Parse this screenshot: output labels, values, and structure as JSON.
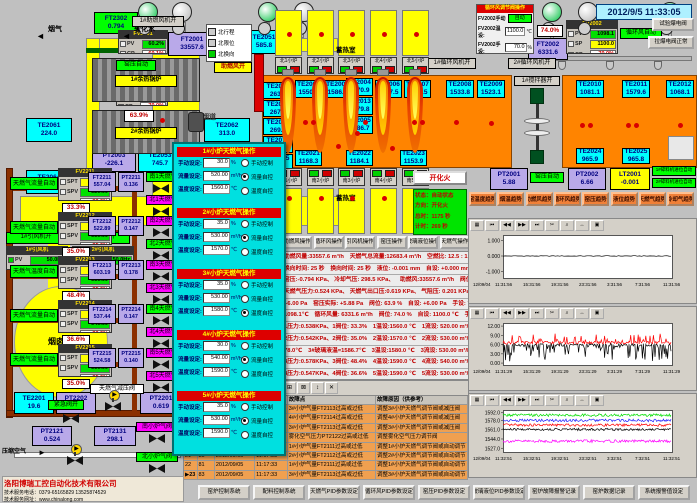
{
  "datetime": "2012/9/5 11:33:05",
  "top_left": {
    "smoke_label": "烟气",
    "soft_water_label": "软化水",
    "boiler1": "1#余热锅炉",
    "boiler2": "2#余热锅炉",
    "idfan1_on": "1#引风机开",
    "idfan2_on": "2#引风机开",
    "idfan1": "1#引风机",
    "idfan2": "2#引风机",
    "idfan_pv": "PV",
    "idfan1_hz": "50.0Hz",
    "idfan2_hz": "50.0Hz",
    "chimney": "烟囱",
    "flue": "烟道",
    "comb_fan_on": "1#助燃风机开",
    "comb_air_open": "助燃风开",
    "press_auto": "窑压自动",
    "reversal_items": [
      {
        "label": "北行程",
        "on": false
      },
      {
        "label": "北限位",
        "on": false
      },
      {
        "label": "北换向",
        "on": true
      }
    ]
  },
  "top_right": {
    "panel_title": "循环风调节阀操作",
    "manual_label": "FV2002手动",
    "manual_mode": "自动",
    "temp_label": "FV2002温设:",
    "temp_value": "1100.0",
    "temp_unit": "℃",
    "hand_label": "FV2002手设:",
    "hand_value": "70.0",
    "hand_unit": "%",
    "btn_test": "试验爆电阀",
    "btn_normal": "拉爆电阀正常",
    "circ_auto": "循环风自动",
    "circ_fan1_on": "1#循环风机开",
    "circ_fan2_on": "2#循环风机开",
    "stirrer1_on": "1#搅拌器开"
  },
  "furnace": {
    "regen_label_north": "蓄热室",
    "regen_label_south": "蓄热室",
    "fire_btn": "开化火",
    "status_lines": [
      "状态：自动状态",
      "方向：开化火",
      "总时：1175 秒",
      "计时：269 秒"
    ],
    "burners_north": [
      "北1小炉",
      "北2小炉",
      "北3小炉",
      "北4小炉",
      "北5小炉"
    ],
    "burners_south": [
      "南1小炉",
      "南2小炉",
      "南3小炉",
      "南4小炉",
      "南5小炉"
    ]
  },
  "sensors": [
    {
      "id": "FT2302",
      "v": "0.794"
    },
    {
      "id": "TE2061",
      "v": "224.0"
    },
    {
      "id": "TE2064",
      "v": "239.0"
    },
    {
      "id": "TE2062",
      "v": "313.0"
    },
    {
      "id": "TE2063",
      "v": "319.0"
    },
    {
      "id": "TE2051",
      "v": "585.8"
    },
    {
      "id": "TE2053",
      "v": "745.7"
    },
    {
      "id": "PT2003",
      "v": "-226.1"
    },
    {
      "id": "FT2001",
      "v": "33557.6"
    },
    {
      "id": "TE2031",
      "v": "1040.1"
    },
    {
      "id": "TE2032",
      "v": "1011.7"
    },
    {
      "id": "TE2033",
      "v": "1025.1"
    },
    {
      "id": "TE2034",
      "v": "1013.3"
    },
    {
      "id": "TE2035",
      "v": "1011.7"
    },
    {
      "id": "TE2071",
      "v": "263.0"
    },
    {
      "id": "TE2072",
      "v": "267.4"
    },
    {
      "id": "TE2073",
      "v": "269.6"
    },
    {
      "id": "TE2074",
      "v": "268.6"
    },
    {
      "id": "TE2075",
      "v": "268.8"
    },
    {
      "id": "TE2001",
      "v": "1550.8"
    },
    {
      "id": "TE2002",
      "v": "1586.2"
    },
    {
      "id": "TE2004",
      "v": "1570.9"
    },
    {
      "id": "TE2013",
      "v": "1579.8"
    },
    {
      "id": "TE2005",
      "v": "1586.7"
    },
    {
      "id": "TE2006",
      "v": "1567.5"
    },
    {
      "id": "TE2007",
      "v": "1538.5"
    },
    {
      "id": "TE2008",
      "v": "1533.8"
    },
    {
      "id": "TE2009",
      "v": "1523.1"
    },
    {
      "id": "TE2010",
      "v": "1081.1"
    },
    {
      "id": "TE2011",
      "v": "1579.6"
    },
    {
      "id": "TE2012",
      "v": "1068.1"
    },
    {
      "id": "TE2021",
      "v": "1168.3"
    },
    {
      "id": "TE2022",
      "v": "1184.1"
    },
    {
      "id": "TE2023",
      "v": "1153.9"
    },
    {
      "id": "TE2024",
      "v": "965.9"
    },
    {
      "id": "TE2025",
      "v": "965.8"
    },
    {
      "id": "TE2041",
      "v": "1209.6"
    },
    {
      "id": "TE2042",
      "v": "1215.0"
    },
    {
      "id": "TE2043",
      "v": "1224.8"
    },
    {
      "id": "TE2044",
      "v": "1212.6"
    },
    {
      "id": "TE2045",
      "v": "1211.8"
    },
    {
      "id": "FT2002",
      "v": "6331.6"
    },
    {
      "id": "PT2001",
      "v": "5.88"
    },
    {
      "id": "PT2002",
      "v": "6.66"
    },
    {
      "id": "LT2001",
      "v": "-0.001"
    },
    {
      "id": "TE2201",
      "v": "19.6"
    },
    {
      "id": "PT2202",
      "v": "0.265"
    },
    {
      "id": "PT2201",
      "v": "0.619"
    },
    {
      "id": "PT2121",
      "v": "0.524"
    },
    {
      "id": "PT2131",
      "v": "298.1"
    }
  ],
  "controllers": [
    {
      "id": "FV2001",
      "rows": [
        [
          "PV",
          "60.2%",
          "vg"
        ],
        [
          "CP",
          "60.1%",
          "vr"
        ]
      ]
    },
    {
      "id": "PV2001",
      "rows": [
        [
          "PV",
          "5.88",
          "vw"
        ],
        [
          "SP",
          "6.00",
          "vg"
        ],
        [
          "CP",
          "70.0%",
          "vr"
        ]
      ]
    },
    {
      "id": "FV2002",
      "rows": [
        [
          "PV",
          "1098.1",
          "vg"
        ],
        [
          "SP",
          "1100.0",
          "vy"
        ],
        [
          "CP",
          "70.0%",
          "vr"
        ]
      ]
    }
  ],
  "pos_boxes": {
    "flue_damper": "63.9%",
    "circ_damper": "74.0%"
  },
  "gas_blocks": [
    {
      "auto": "天燃气流量自动",
      "ctrl": "FV2211",
      "spt": "1560.0",
      "spv": "520.00",
      "cp": "30.0%",
      "ft": "FT2211",
      "ftv": "557.04",
      "pt": "PT2211",
      "ptv": "0.136",
      "pos": "33.3%",
      "vs": "南1天燃气阀",
      "vn": "北1天燃气阀",
      "vsc": "chipG",
      "vnc": "chipM"
    },
    {
      "auto": "天燃气流量自动",
      "ctrl": "FV2212",
      "spt": "1570.0",
      "spv": "530.00",
      "cp": "35.0%",
      "ft": "FT2212",
      "ftv": "522.89",
      "pt": "PT2212",
      "ptv": "0.147",
      "pos": "35.0%",
      "vs": "南2天燃气阀",
      "vn": "北2天燃气阀",
      "vsc": "chipM",
      "vnc": "chipG"
    },
    {
      "auto": "天燃气温度自动",
      "ctrl": "FV2213",
      "spt": "1580.0",
      "spv": "530.00",
      "cp": "35.0%",
      "ft": "FT2213",
      "ftv": "603.19",
      "pt": "PT2213",
      "ptv": "0.178",
      "pos": "48.4%",
      "vs": "南3天燃气阀",
      "vn": "北3天燃气阀",
      "vsc": "chipM",
      "vnc": "chipM"
    },
    {
      "auto": "天燃气流量自动",
      "ctrl": "FV2214",
      "spt": "1590.0",
      "spv": "540.00",
      "cp": "30.0%",
      "ft": "FT2214",
      "ftv": "537.44",
      "pt": "PT2214",
      "ptv": "0.147",
      "pos": "36.6%",
      "vs": "南4天燃气阀",
      "vn": "北4天燃气阀",
      "vsc": "chipG",
      "vnc": "chipM"
    },
    {
      "auto": "天燃气流量自动",
      "ctrl": "FV2215",
      "spt": "1590.0",
      "spv": "530.00",
      "cp": "35.0%",
      "ft": "FT2215",
      "ftv": "524.58",
      "pt": "PT2215",
      "ptv": "0.140",
      "pos": "35.0%",
      "vs": "南5天燃气阀",
      "vn": "北5天燃气阀",
      "vsc": "chipM",
      "vnc": "chipM"
    }
  ],
  "gas_station": {
    "reduce_valve": "天燃气减压阀",
    "emerg": "紧急阀开",
    "comp_air": "压缩空气",
    "vs": "南小炉气阀",
    "vn": "北小炉气阀"
  },
  "popup": {
    "sections": [
      {
        "title": "1#小炉天燃气操作",
        "manual_label": "手动设定:",
        "manual": "30.0",
        "munit": "%",
        "flow_label": "流量设定:",
        "flow": "520.00",
        "funit": "m³/h",
        "temp_label": "温度设定:",
        "temp": "1560.0",
        "tunit": "℃",
        "modes": [
          "手动控制",
          "流量自控",
          "温度自控"
        ],
        "selected": 1
      },
      {
        "title": "2#小炉天燃气操作",
        "manual_label": "手动设定:",
        "manual": "35.0",
        "munit": "%",
        "flow_label": "流量设定:",
        "flow": "530.00",
        "funit": "m³/h",
        "temp_label": "温度设定:",
        "temp": "1570.0",
        "tunit": "℃",
        "modes": [
          "手动控制",
          "流量自控",
          "温度自控"
        ],
        "selected": 1
      },
      {
        "title": "3#小炉天燃气操作",
        "manual_label": "手动设定:",
        "manual": "35.0",
        "munit": "%",
        "flow_label": "流量设定:",
        "flow": "530.00",
        "funit": "m³/h",
        "temp_label": "温度设定:",
        "temp": "1580.0",
        "tunit": "℃",
        "modes": [
          "手动控制",
          "流量自控",
          "温度自控"
        ],
        "selected": 2
      },
      {
        "title": "4#小炉天燃气操作",
        "manual_label": "手动设定:",
        "manual": "30.0",
        "munit": "%",
        "flow_label": "流量设定:",
        "flow": "540.00",
        "funit": "m³/h",
        "temp_label": "温度设定:",
        "temp": "1590.0",
        "tunit": "℃",
        "modes": [
          "手动控制",
          "流量自控",
          "温度自控"
        ],
        "selected": 1
      },
      {
        "title": "5#小炉天燃气操作",
        "manual_label": "手动设定:",
        "manual": "35.0",
        "munit": "%",
        "flow_label": "流量设定:",
        "flow": "530.00",
        "funit": "m³/h",
        "temp_label": "温度设定:",
        "temp": "1590.0",
        "tunit": "℃",
        "modes": [
          "手动控制",
          "流量自控",
          "温度自控"
        ],
        "selected": 1
      }
    ]
  },
  "ops_buttons": [
    "助燃风操作",
    "循环风操作",
    "引风机操作",
    "窑压操作",
    "玻璃液位操作",
    "天燃气操作"
  ],
  "trend_buttons": [
    "窑温度趋势",
    "烟温趋势",
    "助燃风趋势",
    "循环风趋势",
    "窑压趋势",
    "液位趋势",
    "天燃气趋势",
    "冷却气趋势"
  ],
  "right_chips": {
    "press_auto": "窑压自动",
    "crusher1": "1#碎料机进位自动",
    "crusher2": "2#碎料机进位自动"
  },
  "status_lines": [
    "助燃风量:33557.6 m³/h　天燃气总流量:12683.4 m³/h　空燃比: 12.5 : 1　气累积量: 134057.7m³",
    "换向时间: 25 秒　换向时间: 25 秒　液位: -0.001 mm　自设: +0.000 mm　1手设:50.0% 自动　2手设:50.0% 自动",
    "窑压:-0.794 KPa、 冷却气压: 298.5 KPa、　助燃风:33557.6 m³/h　阀位: 60.2%　手设: 60.0%",
    "天燃气压力:0.524 KPa、 天燃气出口压:0.619 KPa、 气阻压: 0.201 KPa、 气温度: 19.6℃",
    "+6.00 Pa　窑压实际: +5.88 Pa　阀位: 63.9 %　自设: +6.00 Pa　手设: 70.0%　自动",
    "1098.1℃　循环风量: 6331.6 m³/h　阀位: 74.0 %　自设: 1100.0 ℃　手设: 70.0%　自动",
    "1压力:0.538KPa、1阀位: 33.3%　1温设:1560.0 ℃　1流设: 520.00 m³/h　1手设: 30.0%　流控",
    "2压力:0.542KPa、2阀位: 35.0%　2温设:1570.0 ℃　2流设: 530.00 m³/h　2手设: 35.0%　流控",
    "78.0℃　3#玻璃液温=1586.7℃　3温设:1580.0 ℃　3流设: 530.00 m³/h　3手设: 35.0%　温控",
    "3压力:0.578KPa、3阀位: 48.4%　4温设:1590.0 ℃　4流设: 540.00 m³/h　4手设: 30.0%　流控",
    "4压力:0.547KPa、4阀位: 36.6%　5温设:1590.0 ℃　5流设: 530.00 m³/h　5手设: 35.0%　流控",
    "5压力:0.540KPa、5阀位: 35.0%"
  ],
  "alarm": {
    "headers": [
      "",
      "",
      "",
      "",
      "故障点",
      "故障原因（供参考）"
    ],
    "rows": [
      [
        "16",
        "84",
        "2012/09/05",
        "11:17:21",
        "3#小炉气量FT2113过高或过低",
        "调整3#小炉天燃气调节阀或减压阀"
      ],
      [
        "17",
        "84",
        "2012/09/05",
        "11:17:25",
        "4#小炉气量FT2114过高或过低",
        "调整4#小炉天燃气调节阀或减压阀"
      ],
      [
        "18",
        "97",
        "2012/09/05",
        "11:17:26",
        "3#小炉气量FT2113过高或过低",
        "调整3#小炉天燃气调节阀或减压阀"
      ],
      [
        "19",
        "75",
        "2012/09/05",
        "11:17:30",
        "雾化空气压力PT2122过高或过低",
        "调整雾化空气压力调节阀"
      ],
      [
        "20",
        "82",
        "2012/09/05",
        "11:17:31",
        "1#小炉气量FT2111过高或过低",
        "调整1#小炉天燃气调节阀或自动调节"
      ],
      [
        "21",
        "85",
        "2012/09/05",
        "11:17:33",
        "2#小炉气量FT2112过高或过低",
        "调整2#小炉天燃气调节阀或自动调节"
      ],
      [
        "22",
        "81",
        "2012/09/05",
        "11:17:33",
        "1#小炉气量FT2111过高或过低",
        "调整1#小炉天燃气调节阀或自动调节"
      ],
      [
        "23",
        "83",
        "2012/09/05",
        "11:17:33",
        "3#小炉气量FT2113过高或过低",
        "调整3#小炉天燃气调节阀或自动调节"
      ]
    ]
  },
  "bottom_buttons": [
    "窑炉控制系统",
    "配料控制系统",
    "天燃气PID参数设定",
    "循环风PID参数设定",
    "窑压PID参数设定",
    "玻璃液位PID参数设定",
    "窑炉故障报警记录",
    "窑炉数据记录",
    "系统报警值设定"
  ],
  "company": {
    "name": "洛阳博瑞工控自动化技术有限公司",
    "phone": "技术服务电话：0379-65165829  13525874529",
    "web": "技术服务网址：www.chinalong.com"
  },
  "chart_toolbar": [
    "▦",
    "⏮",
    "◀◀",
    "▶▶",
    "⏭",
    "✂",
    "⌕",
    "↔",
    "▣"
  ],
  "alarm_toolbar": [
    "▤",
    "≣",
    "?",
    "▶",
    "▷",
    "▦",
    "▩",
    "⊞",
    "⊠",
    "↕",
    "✕"
  ],
  "chart_data": [
    {
      "type": "line",
      "title": "液位趋势",
      "ylim": [
        -1.35,
        1.35
      ],
      "yticks": [
        "1.000",
        "0.000",
        "-1.000"
      ],
      "ytickvals": [
        1,
        0,
        -1
      ],
      "xticks": [
        "12/09/04",
        "11:31:56",
        "15:31:56",
        "19:31:56",
        "23:31:56",
        "3:31:56",
        "7:31:56",
        "11:31:56"
      ],
      "series": [
        {
          "name": "玻璃液位",
          "color": "#000000",
          "base": 0,
          "amp": 0.02,
          "spike": 0,
          "spikeP": 0,
          "dir": 1
        }
      ]
    },
    {
      "type": "line",
      "title": "窑压趋势",
      "ylim": [
        -0.3,
        13
      ],
      "yticks": [
        "12.00",
        "9.00",
        "6.00",
        "3.00",
        "0.00"
      ],
      "ytickvals": [
        12,
        9,
        6,
        3,
        0
      ],
      "xticks": [
        "12/09/04",
        "11:31:29",
        "15:31:29",
        "19:31:29",
        "23:31:29",
        "3:31:29",
        "7:31:29",
        "11:31:29"
      ],
      "series": [
        {
          "name": "窑压SP",
          "color": "#ff0000",
          "base": 6.6,
          "amp": 0.5,
          "spike": 2.8,
          "spikeP": 0.25,
          "dir": 1
        },
        {
          "name": "窑压PV",
          "color": "#000000",
          "base": 5.9,
          "amp": 0.4,
          "spike": 5.2,
          "spikeP": 0.3,
          "dir": -1
        }
      ]
    },
    {
      "type": "line",
      "title": "小炉温度趋势",
      "ylim": [
        1522,
        1597
      ],
      "yticks": [
        "1592.0",
        "1578.0",
        "1561.0",
        "1544.0",
        "1527.0"
      ],
      "ytickvals": [
        1592,
        1578,
        1561,
        1544,
        1527
      ],
      "xticks": [
        "12/09/04",
        "11:32:51",
        "15:32:51",
        "19:32:51",
        "23:32:51",
        "3:32:51",
        "7:32:51",
        "11:32:51"
      ],
      "series": [
        {
          "name": "5#小炉温度",
          "color": "#ff00ff",
          "base": 1540,
          "amp": 2.5,
          "spike": 0,
          "spikeP": 0,
          "dir": 1
        },
        {
          "name": "4#小炉温度",
          "color": "#000000",
          "base": 1561.5,
          "amp": 2.2,
          "spike": 0,
          "spikeP": 0,
          "dir": 1
        },
        {
          "name": "3#小炉温度",
          "color": "#ff0000",
          "base": 1569.5,
          "amp": 2.2,
          "spike": 0,
          "spikeP": 0,
          "dir": 1
        },
        {
          "name": "2#小炉温度",
          "color": "#2222ff",
          "base": 1578,
          "amp": 2.5,
          "spike": 0,
          "spikeP": 0,
          "dir": 1
        },
        {
          "name": "1#小炉温度",
          "color": "#00dd00",
          "base": 1587.5,
          "amp": 2.5,
          "spike": 0,
          "spikeP": 0,
          "dir": 1
        }
      ]
    }
  ]
}
